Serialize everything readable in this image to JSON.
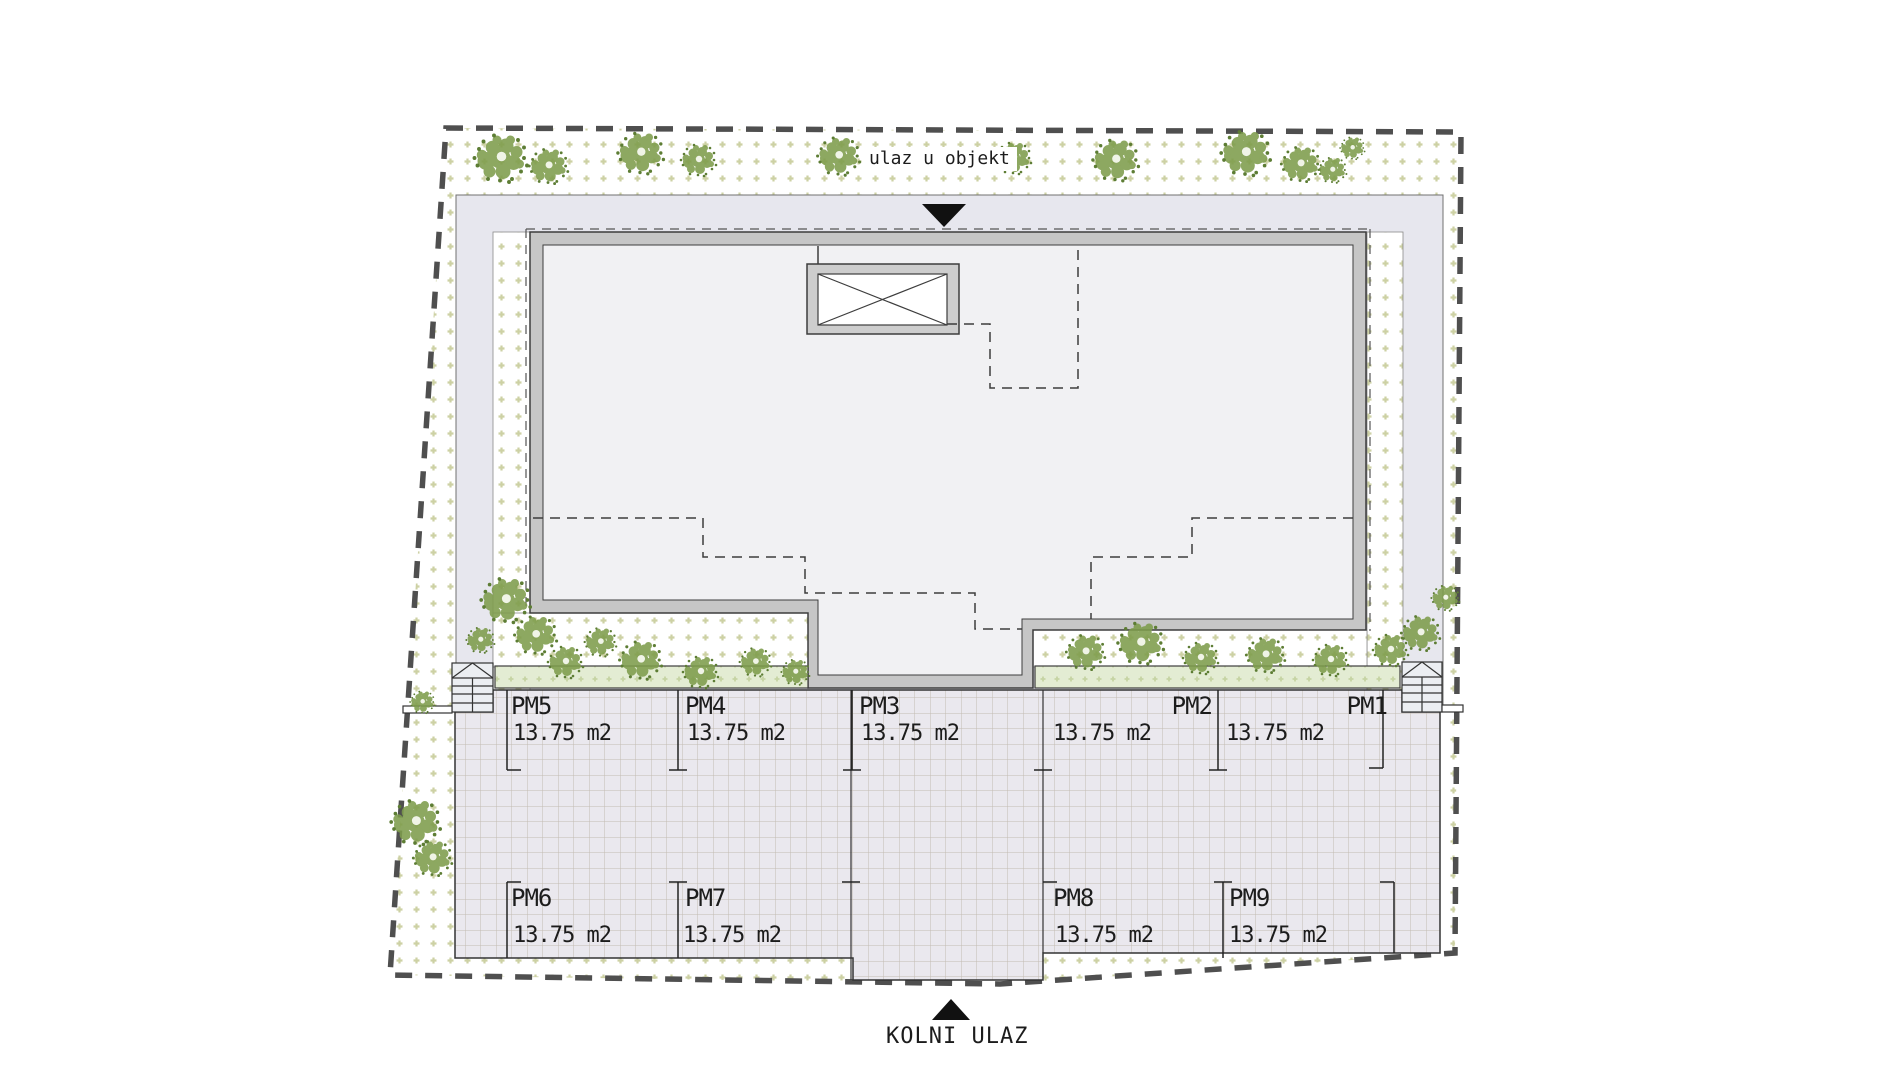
{
  "plan": {
    "labels": {
      "entrance_top": "ulaz u objekt",
      "entrance_bottom": "KOLNI ULAZ"
    },
    "stalls": [
      {
        "name": "PM1",
        "area": "13.75 m2"
      },
      {
        "name": "PM2",
        "area": "13.75 m2"
      },
      {
        "name": "PM3",
        "area": "13.75 m2"
      },
      {
        "name": "PM4",
        "area": "13.75 m2"
      },
      {
        "name": "PM5",
        "area": "13.75 m2"
      },
      {
        "name": "PM6",
        "area": "13.75 m2"
      },
      {
        "name": "PM7",
        "area": "13.75 m2"
      },
      {
        "name": "PM8",
        "area": "13.75 m2"
      },
      {
        "name": "PM9",
        "area": "13.75 m2"
      }
    ],
    "icons": {
      "entrance_arrow": "triangle-down",
      "driveway_arrow": "triangle-up",
      "elevator": "crossed-box",
      "stairs": "stair-treads-with-arrow"
    },
    "colors": {
      "site_boundary": "#4f4f4f",
      "walkway": "#e7e7ee",
      "wall_fill": "#c6c6c6",
      "interior": "#f1f1f3",
      "planter": "#e3ecd3",
      "parking": "#eae8ee",
      "vegetation": "#7e9d4c",
      "arrow": "#111111",
      "text": "#1c1c1c"
    }
  }
}
